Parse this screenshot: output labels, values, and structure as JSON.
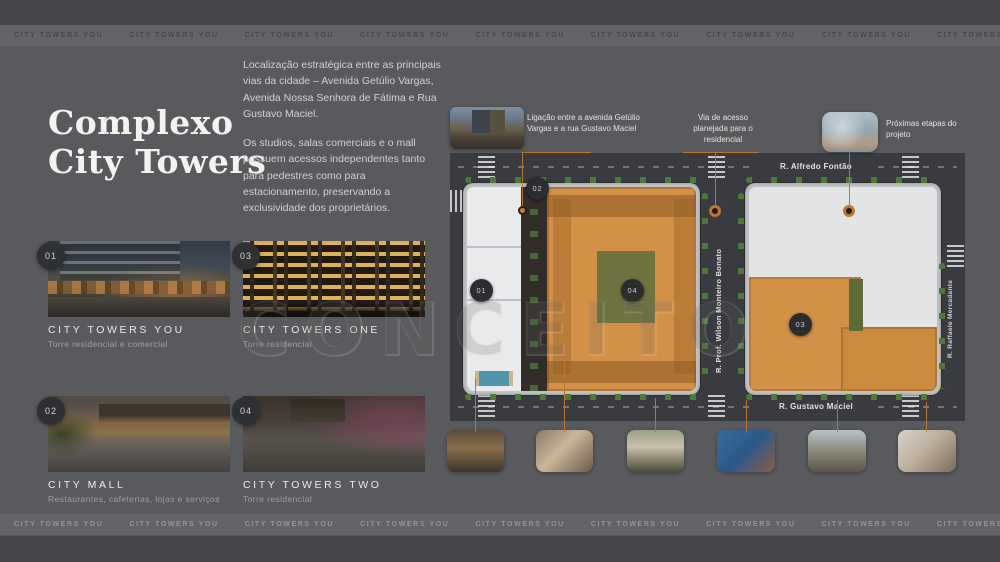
{
  "band": {
    "text": "CITY TOWERS YOU",
    "repeat": 12
  },
  "title": {
    "line1": "Complexo",
    "line2": "City Towers"
  },
  "intro": {
    "p1": "Localização estratégica entre as principais vias da cidade – Avenida Getúlio Vargas, Avenida Nossa Senhora de Fátima e Rua Gustavo Maciel.",
    "p2": "Os studios, salas comerciais e o mall possuem acessos independentes tanto para pedestres como para estacionamento, preservando a exclusividade dos proprietários."
  },
  "projects": [
    {
      "number": "01",
      "name": "CITY TOWERS YOU",
      "subtitle": "Torre residencial e comercial"
    },
    {
      "number": "03",
      "name": "CITY TOWERS ONE",
      "subtitle": "Torre residencial"
    },
    {
      "number": "02",
      "name": "CITY MALL",
      "subtitle": "Restaurantes, cafeterias, lojas e serviços"
    },
    {
      "number": "04",
      "name": "CITY TOWERS TWO",
      "subtitle": "Torre residencial"
    }
  ],
  "map": {
    "streets": {
      "top": "R. Alfredo Fontão",
      "bottom": "R. Gustavo Maciel",
      "center_vertical": "R. Prof. Wilson Monteiro Bonato",
      "right_vertical": "R. Raffaele Mercadante"
    },
    "markers": [
      {
        "label": "01"
      },
      {
        "label": "02"
      },
      {
        "label": "03"
      },
      {
        "label": "04"
      }
    ],
    "annotations": {
      "link": "Ligação entre a avenida Getúlio Vargas e a rua Gustavo Maciel",
      "access": "Via de acesso planejada para o residencial",
      "next_phases": "Próximas etapas do projeto"
    }
  },
  "watermark": "CONCEITO",
  "colors": {
    "accent_orange": "#bf752e",
    "background": "#595a5d",
    "marker_circle": "#2b2d31",
    "block_orange": "#d39147",
    "road": "#393b40"
  }
}
